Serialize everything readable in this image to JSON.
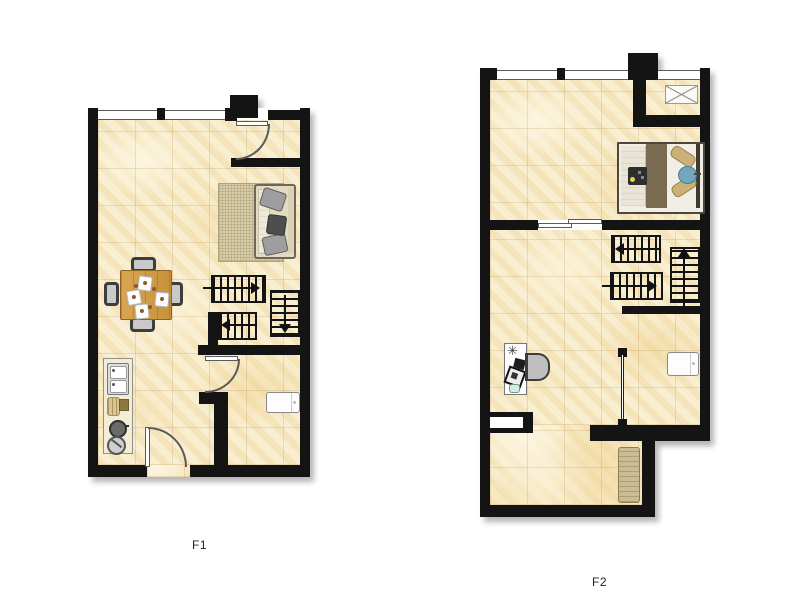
{
  "background": "#ffffff",
  "plan_f1": {
    "label": "F1",
    "items": [
      "window",
      "entry-door",
      "interior-door",
      "sofa",
      "rug",
      "dining-table",
      "dining-chair",
      "place-setting",
      "staircase-run",
      "kitchen-counter",
      "sink",
      "cookware",
      "washing-machine"
    ]
  },
  "plan_f2": {
    "label": "F2",
    "items": [
      "window",
      "vent-box",
      "double-bed",
      "pillow",
      "bed-tray",
      "sliding-door",
      "staircase-run",
      "guard-railing",
      "desk",
      "desk-chair",
      "plant",
      "washing-machine",
      "floor-mat",
      "wall-niche"
    ]
  },
  "colors": {
    "wall": "#141414",
    "floor_base": "#f7ebc8",
    "floor_grid": "#ba9456",
    "table_wood": "#cf9a4d",
    "rug": "#d8cda9",
    "sofa_frame": "#e3dac2",
    "cushion_gray": "#9e9e9e",
    "bed_blanket": "#7a6a52",
    "pillow_tan": "#cbb07a",
    "pillow_blue": "#72a7bc",
    "floor_mat": "#cabb92",
    "door_line": "#5a5a5a"
  }
}
